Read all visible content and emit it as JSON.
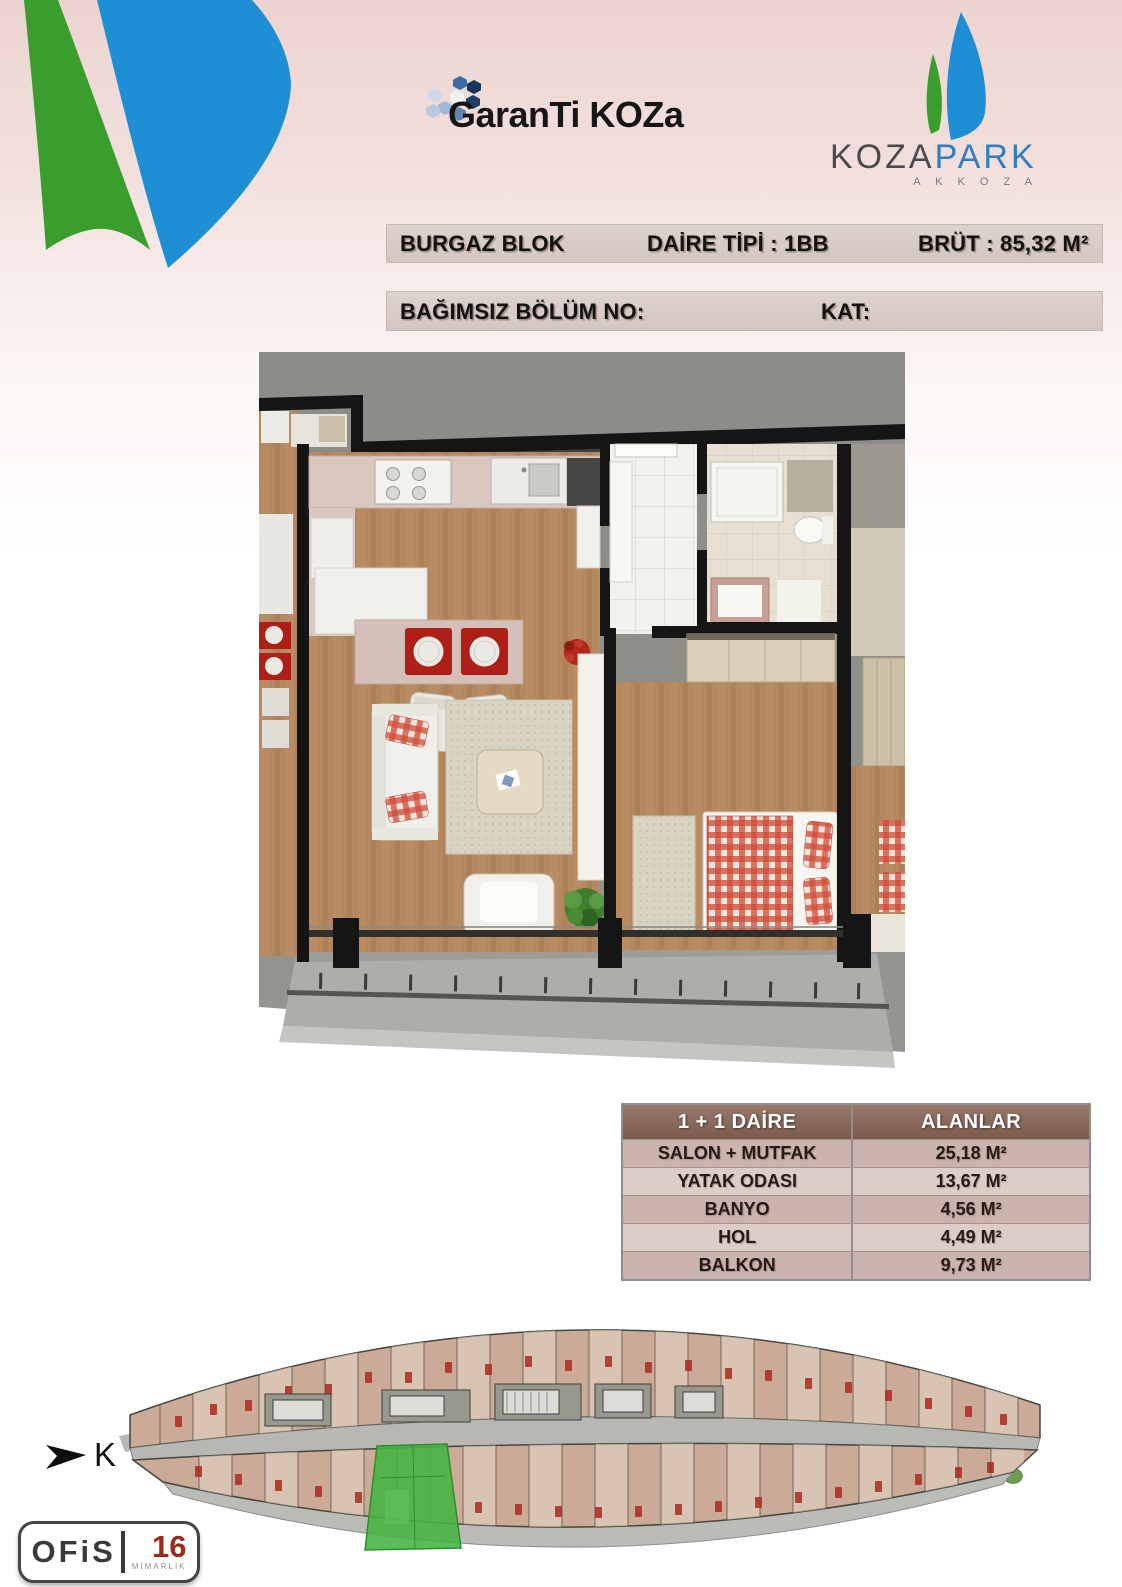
{
  "brand": {
    "garanti_koza": "GaranTi KOZa",
    "kozapark_word1": "KOZA",
    "kozapark_word2": "PARK",
    "kozapark_sub": "A K K O Z A",
    "ofis_name": "OFiS",
    "ofis_number": "16",
    "ofis_sub": "MİMARLIK"
  },
  "header": {
    "block_name": "BURGAZ BLOK",
    "unit_type": "DAİRE TİPİ : 1BB",
    "gross_area": "BRÜT : 85,32 M²",
    "independent_section_label": "BAĞIMSIZ BÖLÜM NO:",
    "floor_label": "KAT:"
  },
  "areas_table": {
    "col1_header": "1 + 1 DAİRE",
    "col2_header": "ALANLAR",
    "rows": [
      {
        "room": "SALON + MUTFAK",
        "area": "25,18 M²"
      },
      {
        "room": "YATAK ODASI",
        "area": "13,67 M²"
      },
      {
        "room": "BANYO",
        "area": "4,56 M²"
      },
      {
        "room": "HOL",
        "area": "4,49 M²"
      },
      {
        "room": "BALKON",
        "area": "9,73 M²"
      }
    ]
  },
  "compass": {
    "north_label": "K"
  },
  "colors": {
    "highlight_green": "#44b442",
    "table_header_brown": "#85665a",
    "accent_red": "#b0281d",
    "sail_green": "#3a9e2f",
    "sail_blue": "#1e8fd5"
  }
}
